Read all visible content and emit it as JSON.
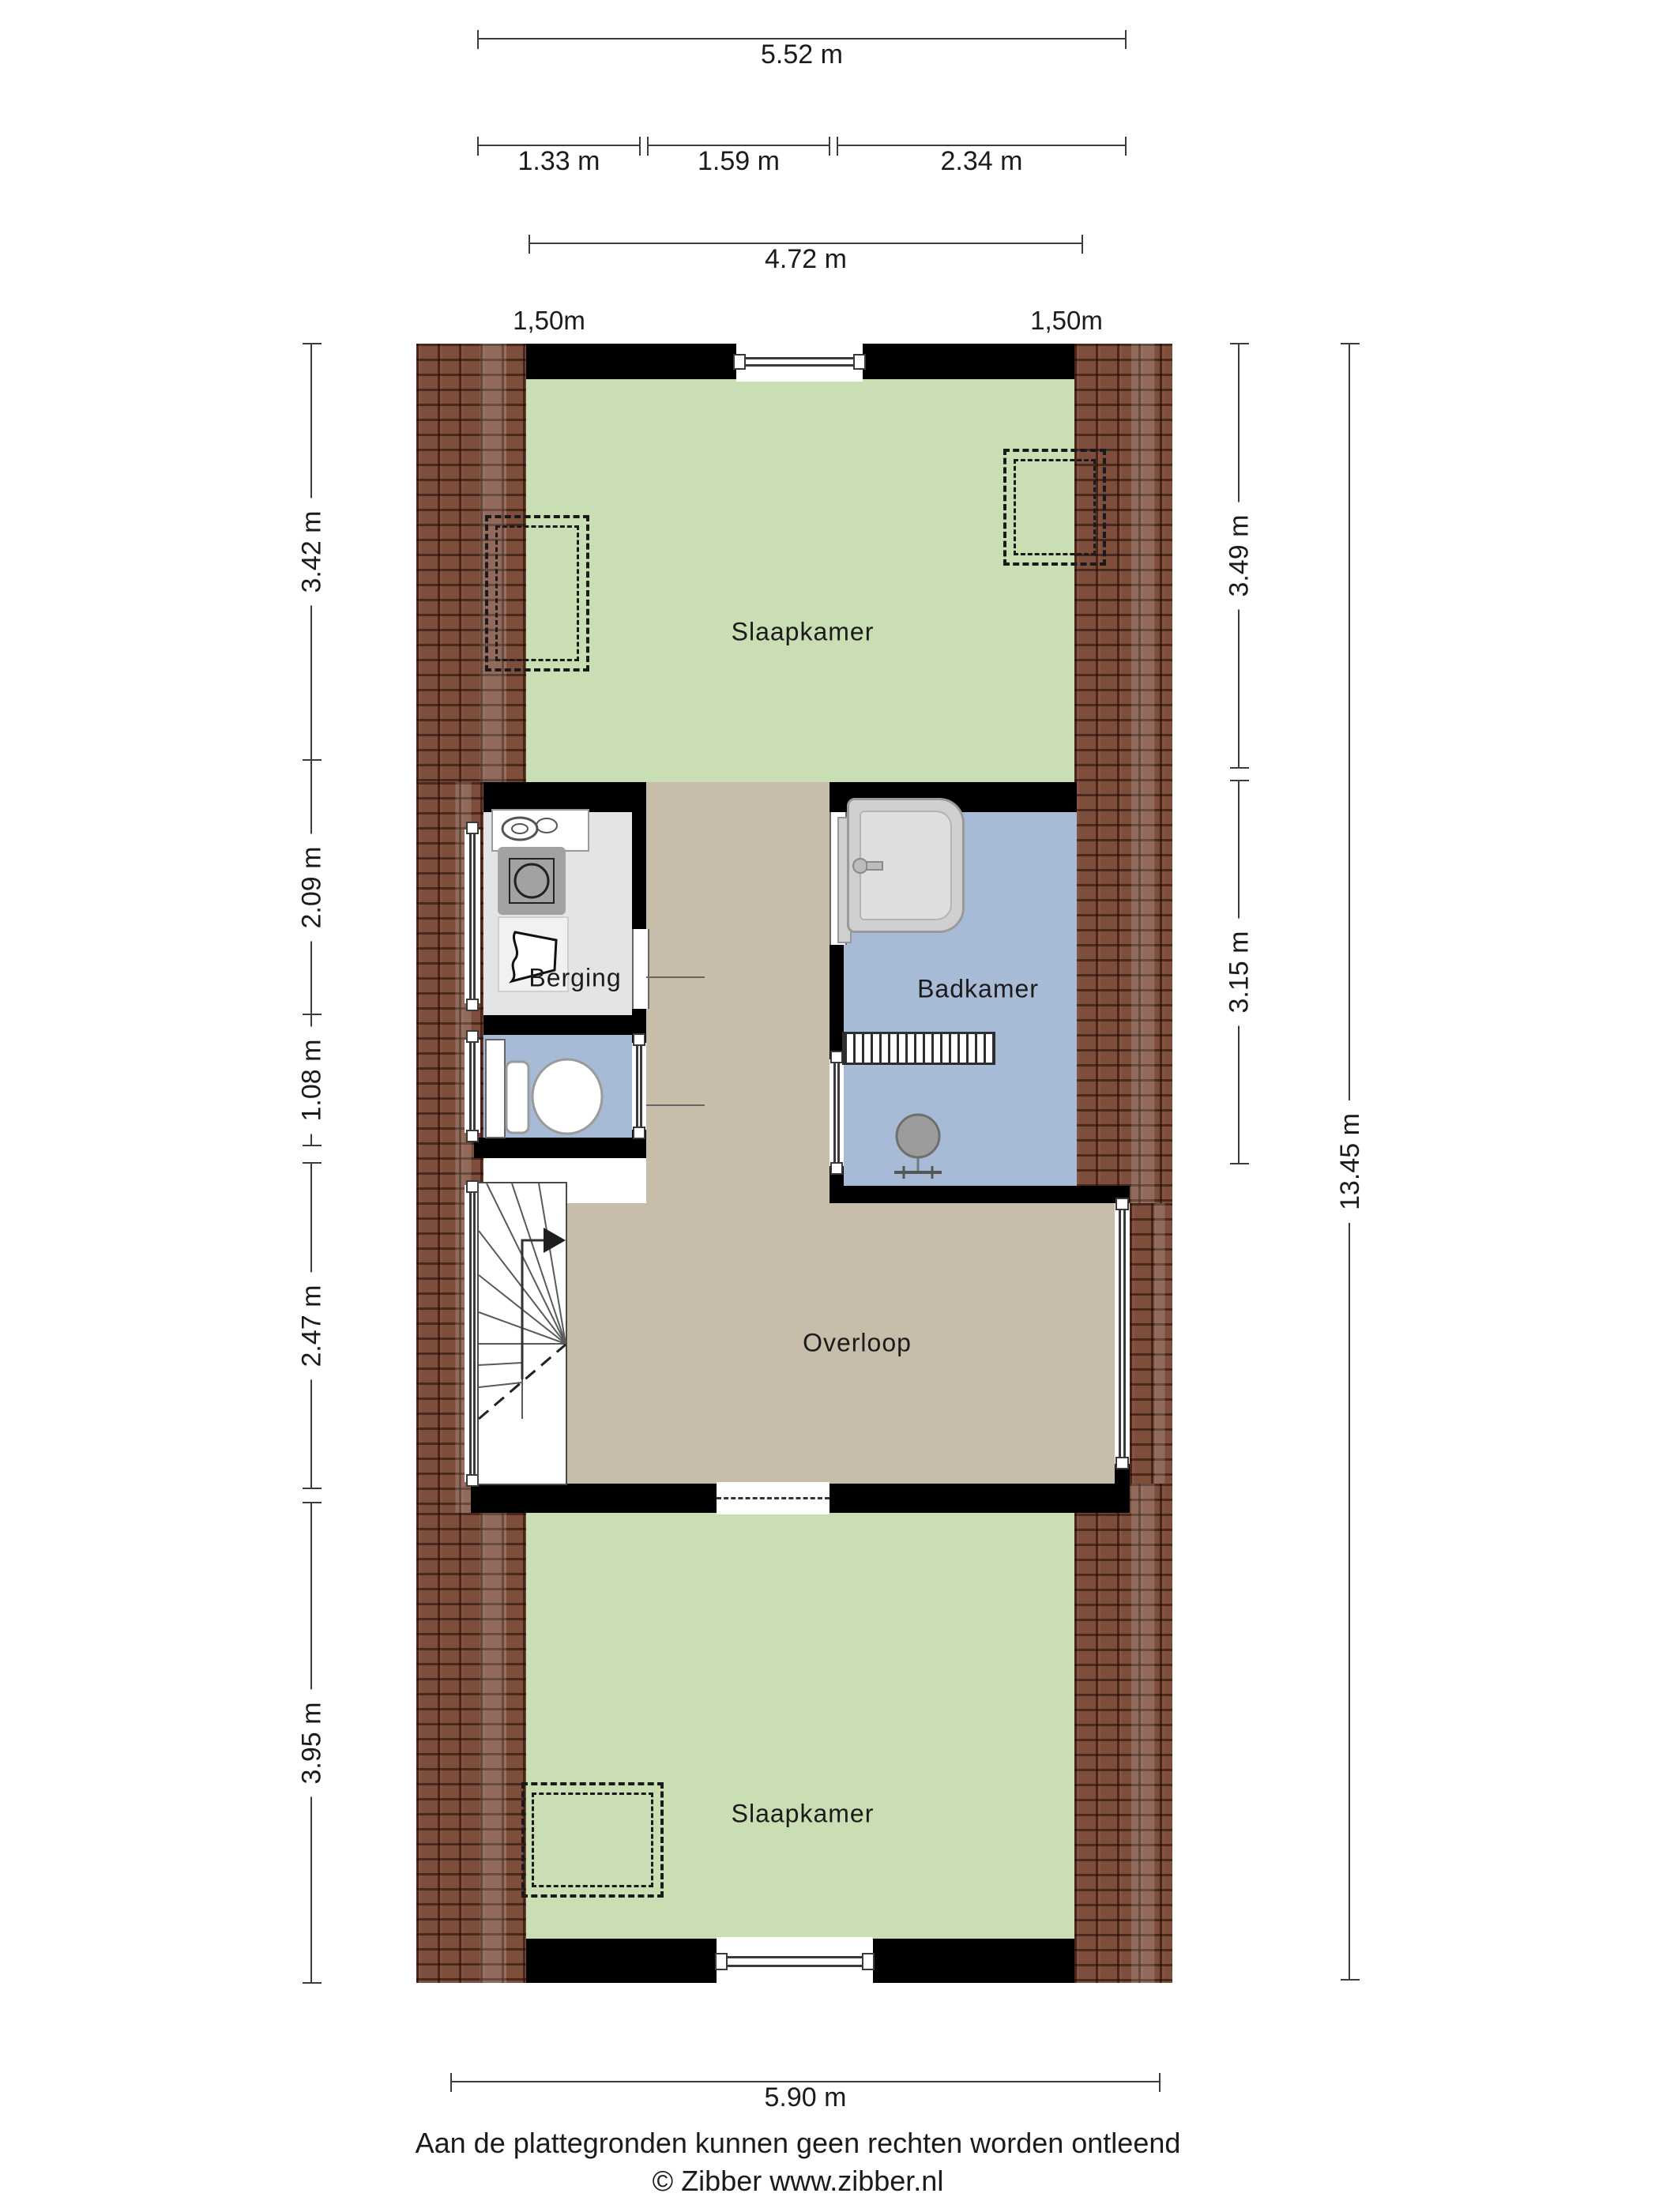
{
  "dims": {
    "top_total": "5.52 m",
    "top_seg1": "1.33 m",
    "top_seg2": "1.59 m",
    "top_seg3": "2.34 m",
    "top_inner": "4.72 m",
    "knee_left": "1,50m",
    "knee_right": "1,50m",
    "left_1": "3.42 m",
    "left_2": "2.09 m",
    "left_3": "1.08 m",
    "left_4": "2.47 m",
    "left_5": "3.95 m",
    "right_1": "3.49 m",
    "right_2": "3.15 m",
    "right_total": "13.45 m",
    "bottom_total": "5.90 m"
  },
  "rooms": {
    "slaapkamer_top": "Slaapkamer",
    "berging": "Berging",
    "badkamer": "Badkamer",
    "overloop": "Overloop",
    "slaapkamer_bottom": "Slaapkamer"
  },
  "footer": {
    "disclaimer": "Aan de plattegronden kunnen geen rechten worden ontleend",
    "credit": "© Zibber www.zibber.nl"
  },
  "colors": {
    "bedroom_floor": "#c9deb3",
    "landing_floor": "#c8bcab",
    "bathroom_floor": "#a7bbd6",
    "storage_floor": "#e4e4e4",
    "roof_tiles": "#7d4e3c",
    "wall": "#000000",
    "dimension_line": "#3c3c3c"
  }
}
